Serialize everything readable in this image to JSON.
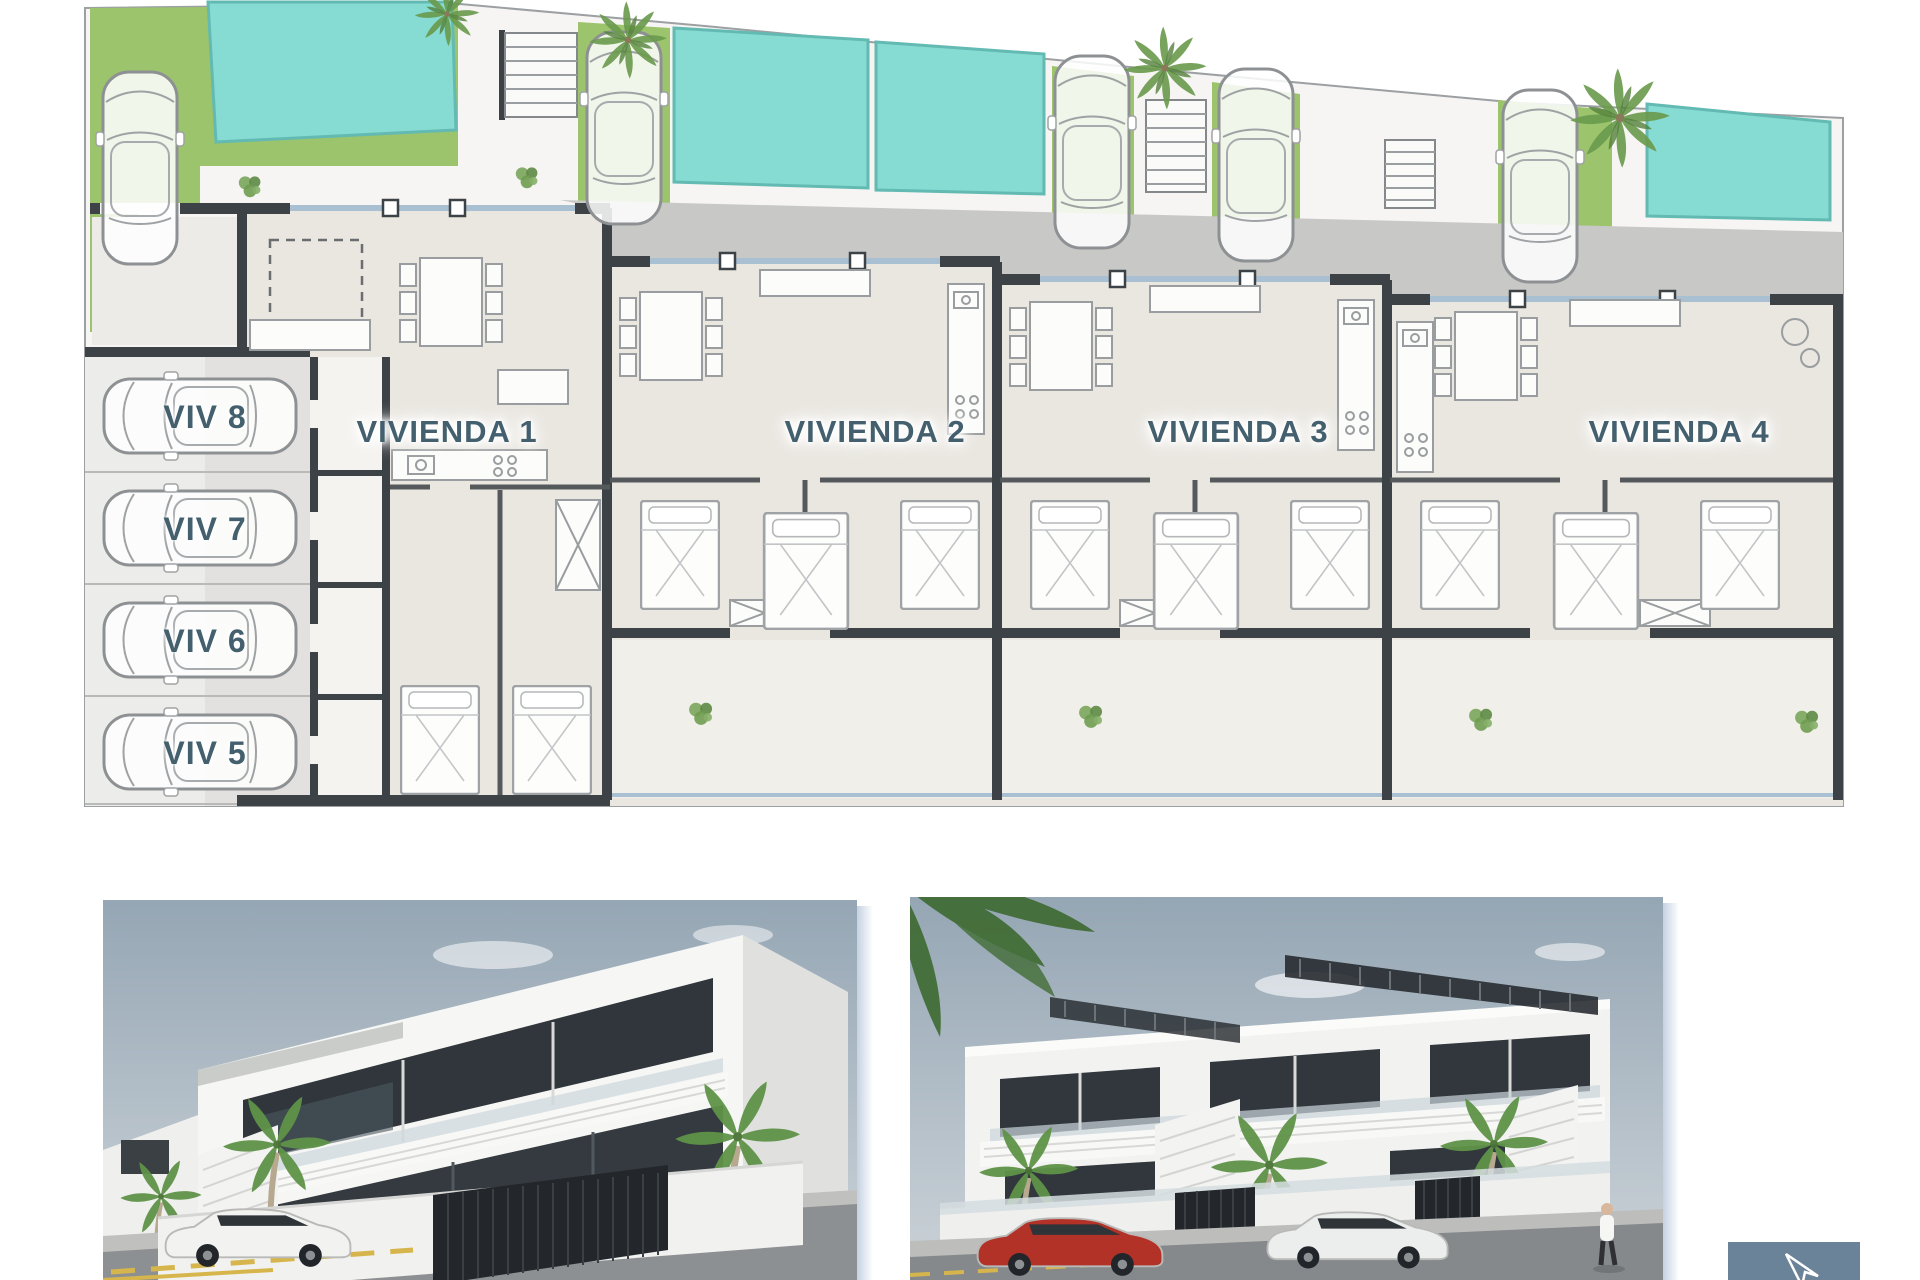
{
  "floor_plan": {
    "units": [
      {
        "label": "VIVIENDA 1"
      },
      {
        "label": "VIVIENDA 2"
      },
      {
        "label": "VIVIENDA 3"
      },
      {
        "label": "VIVIENDA 4"
      }
    ],
    "parking_spaces": [
      {
        "label": "VIV 8"
      },
      {
        "label": "VIV 7"
      },
      {
        "label": "VIV 6"
      },
      {
        "label": "VIV 5"
      }
    ]
  },
  "icons": {
    "car_plan": "car-top-view-icon",
    "car_render": "car-side-view-icon",
    "palm": "palm-tree-icon",
    "plant": "plant-icon",
    "stairs": "stairs-icon",
    "pool": "swimming-pool",
    "person": "pedestrian-icon",
    "cursor": "mouse-cursor-icon"
  },
  "colors": {
    "label_text": "#44606e",
    "label_glow": "#ffffff",
    "pool_water": "#86dbd2",
    "pool_edge": "#62bab2",
    "grass": "#9cc46c",
    "grass_dark": "#85b25a",
    "plan_wall": "#3d4246",
    "partition": "#55595c",
    "plan_floor": "#eae7e1",
    "floor_light": "#f4f3f0",
    "driveway": "#c8c8c6",
    "parking_surface": "#e2e1df",
    "parking_light": "#efefed",
    "furniture_line": "#9a9d9f",
    "furniture_fill": "#fcfcfb",
    "glass_line": "#a9bfd2",
    "site_line": "#9ca0a3",
    "sky_top": "#95a6b4",
    "sky_bottom": "#cdd4d9",
    "building_white": "#f5f5f3",
    "building_shade": "#e0e1df",
    "window_dark": "#30363b",
    "street": "#8a8e90",
    "sidewalk": "#bcbdbb",
    "marking_yellow": "#d6b64c",
    "fence_dark": "#24282c",
    "palm_green": "#6a9a4c",
    "red_car": "#b23227",
    "white_car": "#f1f1ef",
    "shadow_blue": "#93abc4",
    "cursor_panel": "#6b8399",
    "cursor_arrow": "#ffffff"
  }
}
